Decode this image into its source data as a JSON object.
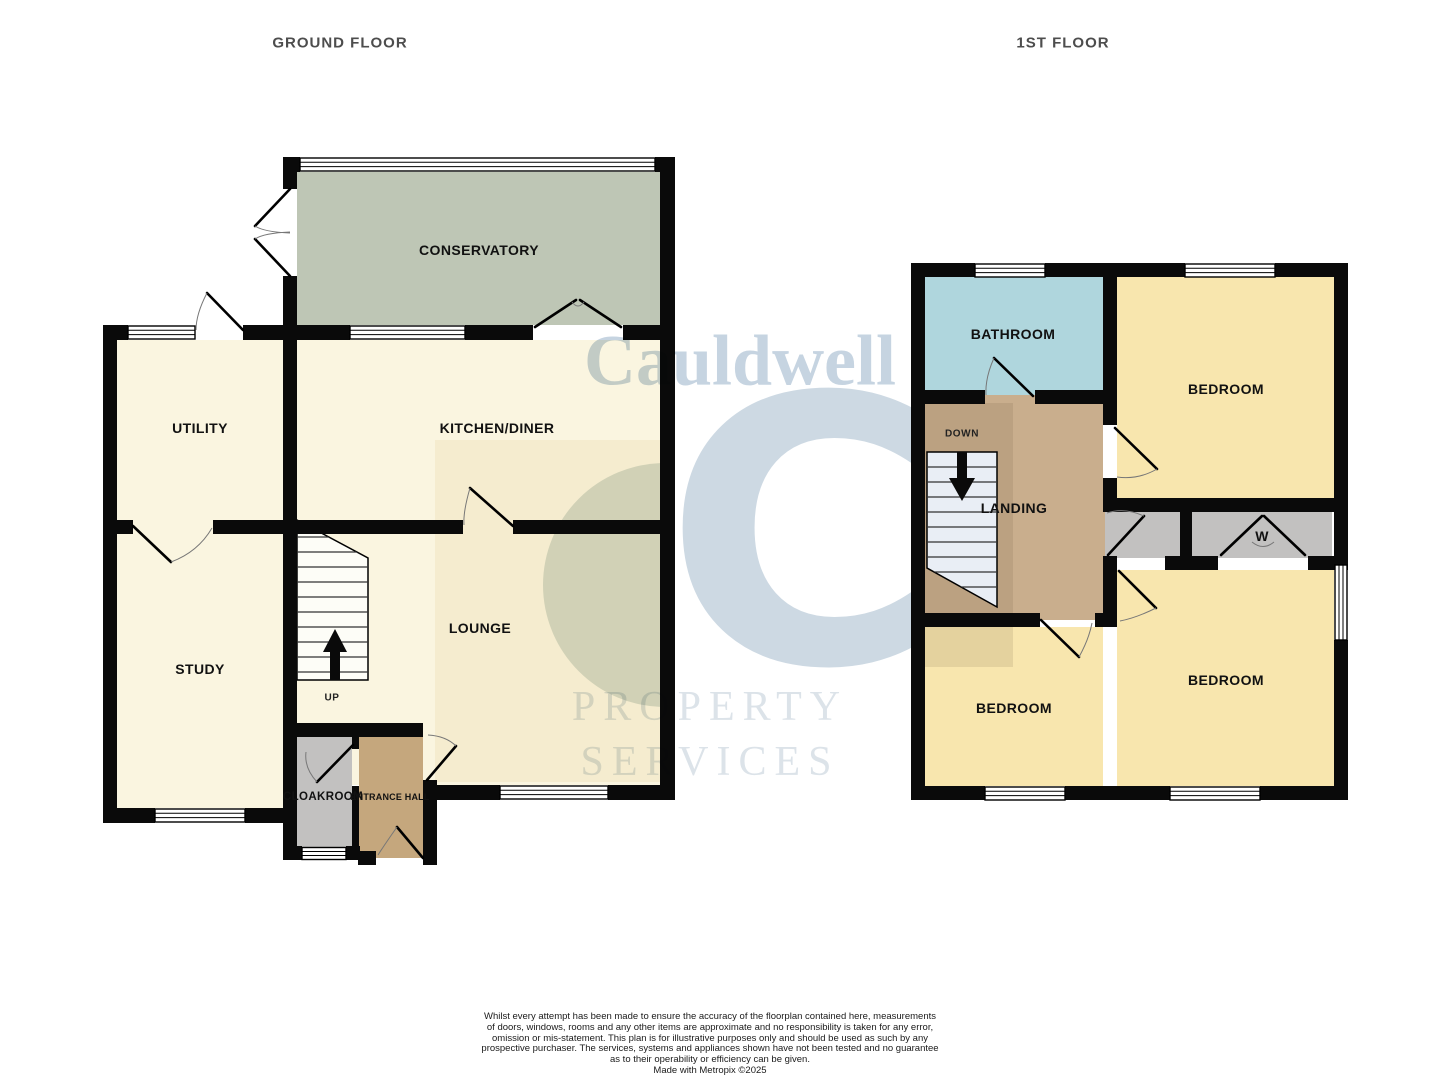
{
  "floorplan": {
    "ground": {
      "title": "GROUND FLOOR",
      "labels": {
        "conservatory": "CONSERVATORY",
        "utility": "UTILITY",
        "kitchen": "KITCHEN/DINER",
        "study": "STUDY",
        "lounge": "LOUNGE",
        "cloakroom": "CLOAKROOM",
        "entrance_hall": "ENTRANCE HALL",
        "stairs": "UP"
      }
    },
    "first": {
      "title": "1ST FLOOR",
      "labels": {
        "bathroom": "BATHROOM",
        "bedroom_front": "BEDROOM",
        "landing": "LANDING",
        "stairs": "DOWN",
        "wardrobe": "W",
        "bedroom_back_left": "BEDROOM",
        "bedroom_back_right": "BEDROOM"
      }
    }
  },
  "watermark": {
    "brand": "Cauldwell",
    "monogram": "C",
    "line1": "PROPERTY",
    "line2": "SERVICES"
  },
  "disclaimer": {
    "lines": [
      "Whilst every attempt has been made to ensure the accuracy of the floorplan contained here, measurements",
      "of doors, windows, rooms and any other items are approximate and no responsibility is taken for any error,",
      "omission or mis-statement. This plan is for illustrative purposes only and should be used as such by any",
      "prospective purchaser. The services, systems and appliances shown have not been tested and no guarantee",
      "as to their operability or efficiency can be given."
    ],
    "credit": "Made with Metropix ©2025"
  },
  "colors": {
    "wall": "#0a0a0a",
    "room_cream": "#faf5e0",
    "room_yellow": "#f8e6ae",
    "room_blue": "#afd6dd",
    "room_sage": "#bec6b5",
    "tan_landing": "#c9ae8d",
    "tan_hall": "#c5a77d",
    "room_gray": "#c2c1c0",
    "stair_ground": "#fdfdf7",
    "stair_first": "#e9eef5",
    "wm_blue": "#cdd9e3",
    "wm_text": "#c6d4e1",
    "wm_faint": "#dce3e9",
    "title_gray": "#4d4d4d",
    "label_black": "#111111"
  }
}
